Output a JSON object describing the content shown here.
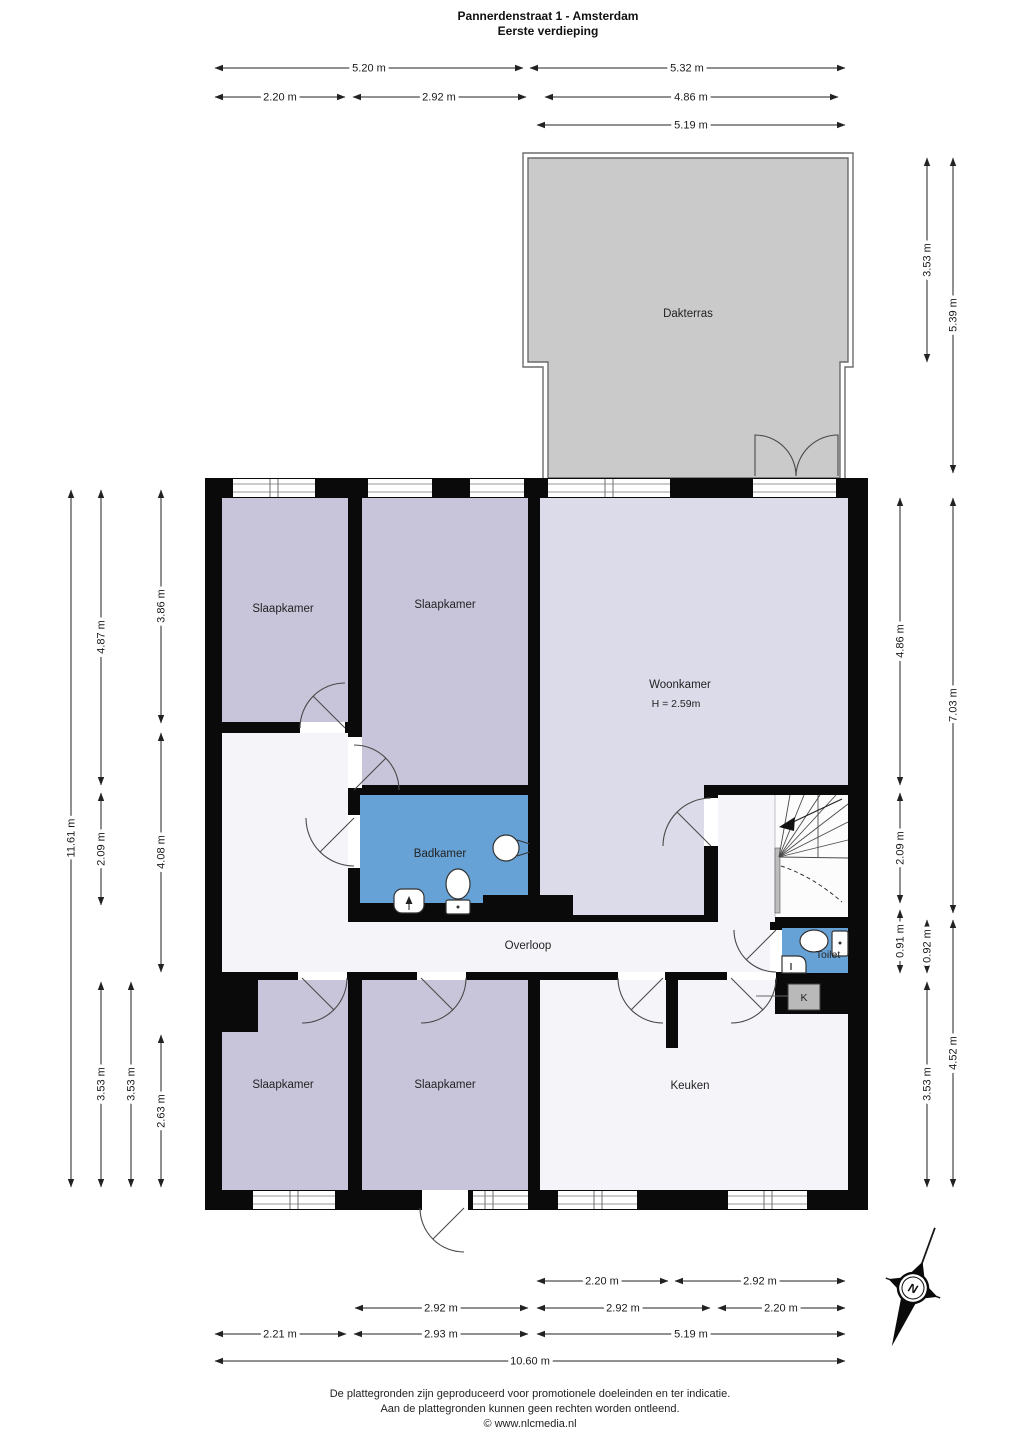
{
  "title": {
    "line1": "Pannerdenstraat 1 - Amsterdam",
    "line2": "Eerste verdieping"
  },
  "floor_plan": {
    "rooms": {
      "dakterras": "Dakterras",
      "slaapkamer_top_left": "Slaapkamer",
      "slaapkamer_top_mid": "Slaapkamer",
      "woonkamer": "Woonkamer",
      "woonkamer_ceiling_height": "H = 2.59m",
      "badkamer": "Badkamer",
      "overloop": "Overloop",
      "toilet": "Toilet",
      "keuken": "Keuken",
      "slaapkamer_bottom_left": "Slaapkamer",
      "slaapkamer_bottom_mid": "Slaapkamer",
      "closet": "K"
    }
  },
  "dimensions": {
    "top": [
      "5.20 m",
      "5.32 m",
      "2.20 m",
      "2.92 m",
      "4.86 m",
      "5.19 m"
    ],
    "bottom": [
      "2.20 m",
      "2.92 m",
      "2.92 m",
      "2.92 m",
      "2.20 m",
      "2.21 m",
      "2.93 m",
      "5.19 m",
      "10.60 m"
    ],
    "left": [
      "11.61 m",
      "4.87 m",
      "2.09 m",
      "3.53 m",
      "3.53 m",
      "3.86 m",
      "4.08 m",
      "2.63 m"
    ],
    "right": [
      "3.53 m",
      "5.39 m",
      "4.86 m",
      "2.09 m",
      "0.91 m",
      "0.92 m",
      "3.53 m",
      "7.03 m",
      "4.52 m"
    ]
  },
  "compass": {
    "north_label": "N"
  },
  "footer": {
    "line1": "De plattegronden zijn geproduceerd voor promotionele doeleinden en ter indicatie.",
    "line2": "Aan de plattegronden kunnen geen rechten worden ontleend.",
    "line3": "© www.nlcmedia.nl"
  },
  "colors": {
    "wall": "#0a0a0a",
    "bedroom_fill": "#c8c5da",
    "living_fill": "#dcdbe9",
    "wet_room_fill": "#67a2d6",
    "terrace_fill": "#cacaca",
    "floor_fill": "#f5f4f9",
    "dimension_text": "#1a1a1a"
  }
}
